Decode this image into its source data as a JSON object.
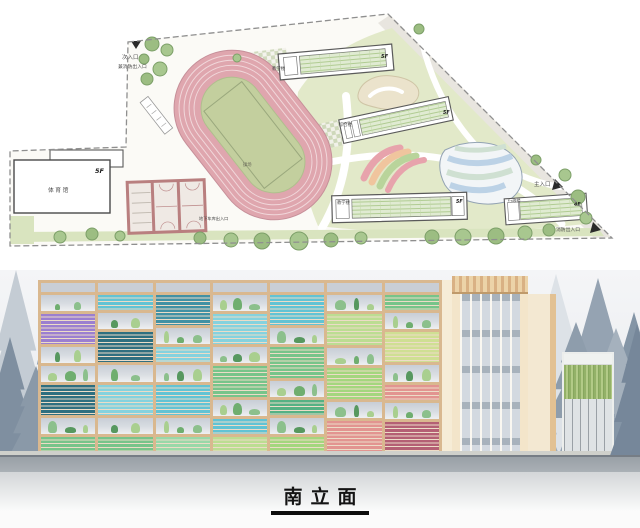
{
  "site_plan": {
    "entrances": [
      {
        "label": "次入口",
        "note": "兼消防出入口"
      },
      {
        "label": "主入口"
      },
      {
        "label": "消防出入口"
      },
      {
        "label": "地下车库出入口"
      }
    ],
    "buildings": [
      {
        "label": "体育馆",
        "floors": "5F"
      },
      {
        "label": "教学楼",
        "floors": "5F"
      },
      {
        "label": "综合楼",
        "floors": "5F"
      },
      {
        "label": "教学楼",
        "floors": "5F"
      },
      {
        "label": "行政楼",
        "floors": "4F"
      }
    ],
    "field_label": "操场",
    "colors": {
      "track": "#dfa6ae",
      "infield": "#c3cf9e",
      "lawn": "#d9e4bf",
      "landscape": "#e2e9c9",
      "tree": "#a6c48e"
    },
    "trees": [
      [
        152,
        44,
        7
      ],
      [
        167,
        50,
        6
      ],
      [
        144,
        59,
        5
      ],
      [
        160,
        69,
        7
      ],
      [
        147,
        79,
        6
      ],
      [
        237,
        58,
        4
      ],
      [
        419,
        29,
        5
      ],
      [
        60,
        237,
        6
      ],
      [
        92,
        234,
        6
      ],
      [
        120,
        236,
        5
      ],
      [
        200,
        238,
        6
      ],
      [
        231,
        240,
        7
      ],
      [
        262,
        241,
        8
      ],
      [
        299,
        241,
        9
      ],
      [
        331,
        240,
        7
      ],
      [
        361,
        238,
        6
      ],
      [
        432,
        237,
        7
      ],
      [
        463,
        237,
        8
      ],
      [
        496,
        236,
        8
      ],
      [
        525,
        233,
        7
      ],
      [
        549,
        230,
        6
      ],
      [
        565,
        175,
        6
      ],
      [
        578,
        197,
        7
      ],
      [
        586,
        218,
        6
      ],
      [
        536,
        160,
        5
      ]
    ]
  },
  "elevation": {
    "title": "南立面",
    "palette": {
      "frame": "#d9b88f",
      "planter_bg": "#ccd2d9",
      "plants": [
        "#6fae6f",
        "#8cc08c",
        "#57985f",
        "#a9cf8f"
      ],
      "louvers": {
        "purple": "#9b7fd0",
        "darkteal": "#2f6f80",
        "teal": "#4291a4",
        "cyan": "#62c3d4",
        "lightblue": "#85d2de",
        "green": "#77c48a",
        "seagreen": "#55b184",
        "mint": "#99d8a8",
        "palegreen": "#bcdd92",
        "lightgreen": "#a4d67e",
        "yellowgreen": "#cfdf93",
        "salmon": "#e29490",
        "maroon": "#b46074"
      }
    },
    "facade_columns": [
      [
        {
          "t": "planter",
          "h": 1
        },
        {
          "t": "louver",
          "h": 2,
          "c": "purple"
        },
        {
          "t": "planter",
          "h": 1
        },
        {
          "t": "planter",
          "h": 1
        },
        {
          "t": "louver",
          "h": 2,
          "c": "darkteal"
        },
        {
          "t": "planter",
          "h": 1
        },
        {
          "t": "louver",
          "h": 1,
          "c": "green"
        }
      ],
      [
        {
          "t": "louver",
          "h": 1,
          "c": "cyan"
        },
        {
          "t": "planter",
          "h": 1
        },
        {
          "t": "louver",
          "h": 2,
          "c": "darkteal"
        },
        {
          "t": "planter",
          "h": 1
        },
        {
          "t": "louver",
          "h": 2,
          "c": "lightblue"
        },
        {
          "t": "planter",
          "h": 1
        },
        {
          "t": "louver",
          "h": 1,
          "c": "green"
        }
      ],
      [
        {
          "t": "louver",
          "h": 2,
          "c": "teal"
        },
        {
          "t": "planter",
          "h": 1
        },
        {
          "t": "louver",
          "h": 1,
          "c": "lightblue"
        },
        {
          "t": "planter",
          "h": 1
        },
        {
          "t": "louver",
          "h": 2,
          "c": "cyan"
        },
        {
          "t": "planter",
          "h": 1
        },
        {
          "t": "louver",
          "h": 1,
          "c": "mint"
        }
      ],
      [
        {
          "t": "planter",
          "h": 1
        },
        {
          "t": "louver",
          "h": 2,
          "c": "lightblue"
        },
        {
          "t": "planter",
          "h": 1
        },
        {
          "t": "louver",
          "h": 2,
          "c": "green"
        },
        {
          "t": "planter",
          "h": 1
        },
        {
          "t": "louver",
          "h": 1,
          "c": "cyan"
        },
        {
          "t": "louver",
          "h": 1,
          "c": "palegreen"
        }
      ],
      [
        {
          "t": "louver",
          "h": 2,
          "c": "cyan"
        },
        {
          "t": "planter",
          "h": 1
        },
        {
          "t": "louver",
          "h": 2,
          "c": "green"
        },
        {
          "t": "planter",
          "h": 1
        },
        {
          "t": "louver",
          "h": 1,
          "c": "seagreen"
        },
        {
          "t": "planter",
          "h": 1
        },
        {
          "t": "louver",
          "h": 1,
          "c": "lightgreen"
        }
      ],
      [
        {
          "t": "planter",
          "h": 1
        },
        {
          "t": "louver",
          "h": 2,
          "c": "palegreen"
        },
        {
          "t": "planter",
          "h": 1
        },
        {
          "t": "louver",
          "h": 2,
          "c": "lightgreen"
        },
        {
          "t": "planter",
          "h": 1
        },
        {
          "t": "louver",
          "h": 2,
          "c": "salmon"
        }
      ],
      [
        {
          "t": "louver",
          "h": 1,
          "c": "green"
        },
        {
          "t": "planter",
          "h": 1
        },
        {
          "t": "louver",
          "h": 2,
          "c": "yellowgreen"
        },
        {
          "t": "planter",
          "h": 1
        },
        {
          "t": "louver",
          "h": 1,
          "c": "salmon"
        },
        {
          "t": "planter",
          "h": 1
        },
        {
          "t": "louver",
          "h": 2,
          "c": "maroon"
        }
      ]
    ],
    "pines_back": [
      {
        "x": 16,
        "b": 192,
        "w": 78,
        "h": 192,
        "c": "#c4ccd4"
      },
      {
        "x": 54,
        "b": 192,
        "w": 66,
        "h": 168,
        "c": "#93a1b0"
      },
      {
        "x": 10,
        "b": 192,
        "w": 56,
        "h": 125,
        "c": "#7f8fa0"
      },
      {
        "x": 88,
        "b": 192,
        "w": 52,
        "h": 122,
        "c": "#a7b2bd"
      },
      {
        "x": 36,
        "b": 192,
        "w": 60,
        "h": 96,
        "c": "#8a99a8"
      },
      {
        "x": 556,
        "b": 192,
        "w": 84,
        "h": 188,
        "c": "#dde2e7"
      },
      {
        "x": 598,
        "b": 192,
        "w": 84,
        "h": 184,
        "c": "#95a3b2"
      },
      {
        "x": 634,
        "b": 192,
        "w": 72,
        "h": 150,
        "c": "#8495a6"
      },
      {
        "x": 540,
        "b": 192,
        "w": 44,
        "h": 92,
        "c": "#9fadbb"
      },
      {
        "x": 576,
        "b": 148,
        "w": 58,
        "h": 96,
        "c": "#8e9dac"
      },
      {
        "x": 616,
        "b": 144,
        "w": 52,
        "h": 86,
        "c": "#a5b1bd"
      }
    ],
    "pines_front": [
      {
        "x": 637,
        "b": 194,
        "w": 60,
        "h": 140,
        "c": "#76879a"
      }
    ]
  }
}
